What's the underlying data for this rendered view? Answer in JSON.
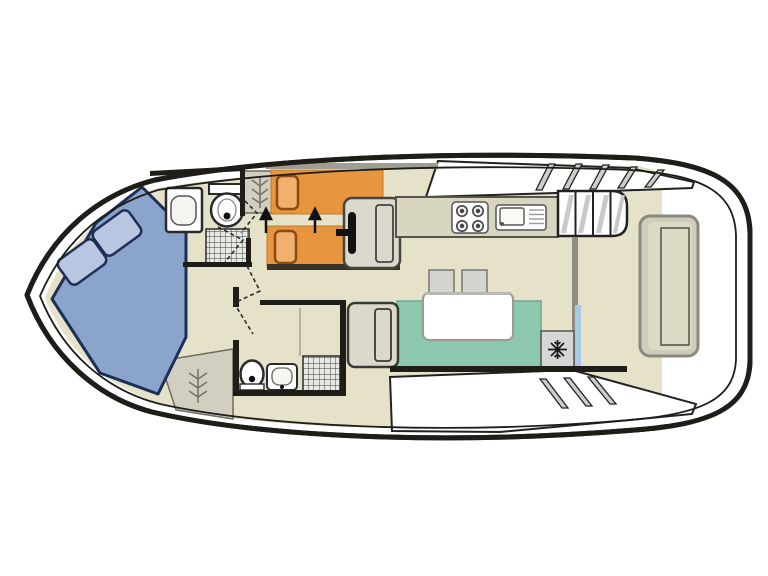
{
  "window": {
    "width": 768,
    "height": 576
  },
  "diagram": {
    "type": "boat-deck-plan",
    "view": "top-down interior layout of a motor cruiser",
    "colors": {
      "outline": "#1f1d17",
      "floor": "#e6e2c9",
      "counter": "#d8d5c0",
      "double_bed": "#8ba4cc",
      "double_pillow": "#b9c6e1",
      "double_bed_border": "#1e2f55",
      "single_bed": "#e7953f",
      "single_pillow": "#f1b16d",
      "single_bed_border": "#8a4a12",
      "sofa": "#8cc7ae",
      "seat_grey": "#dbd9cc",
      "wardrobe": "#d2cfc1",
      "glass_door": "#a9cbe2",
      "shadow": "#3a3329",
      "hatch_grey": "#cdcdc9",
      "wall": "#1f1d17",
      "white": "#ffffff"
    },
    "rooms": [
      {
        "name": "bow-cabin",
        "furniture": [
          "double-bed",
          "pillow",
          "pillow",
          "wardrobe"
        ]
      },
      {
        "name": "forward-bathroom",
        "furniture": [
          "sink",
          "toilet",
          "shower-tray"
        ]
      },
      {
        "name": "twin-cabin",
        "furniture": [
          "single-bed",
          "single-bed",
          "wardrobe",
          "bed-join-arrows"
        ]
      },
      {
        "name": "helm",
        "furniture": [
          "helm-seat",
          "steering-wheel"
        ]
      },
      {
        "name": "galley",
        "furniture": [
          "counter",
          "four-burner-hob",
          "sink-with-drainer"
        ]
      },
      {
        "name": "saloon",
        "furniture": [
          "u-shaped-sofa",
          "table",
          "stool",
          "stool",
          "fridge",
          "bench-seat"
        ]
      },
      {
        "name": "aft-bathroom",
        "furniture": [
          "toilet",
          "sink",
          "shower-tray"
        ]
      },
      {
        "name": "aft-deck",
        "furniture": [
          "stern-bench",
          "companionway-steps",
          "sliding-glass-door"
        ]
      }
    ],
    "icons": [
      "snowflake-icon",
      "shower-hatch",
      "wardrobe-branch-icon",
      "door-swing-dashes",
      "window-hatch-stripes",
      "steering-wheel-icon"
    ]
  }
}
